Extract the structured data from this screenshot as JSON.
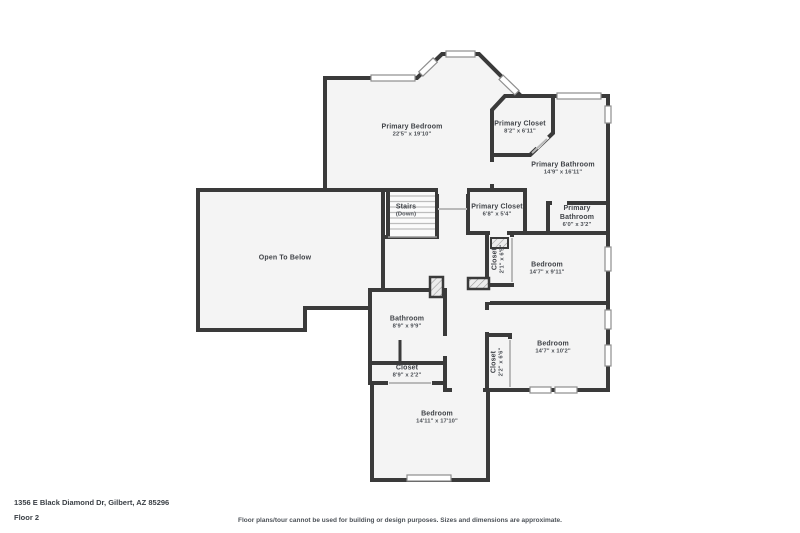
{
  "colors": {
    "wall": "#3a3a3a",
    "floor": "#f4f4f4",
    "window_border": "#8e8e8e",
    "door_line": "#b9b9b9",
    "label_text": "#3f4247"
  },
  "floor_plan": {
    "rooms": [
      {
        "id": "primary-bedroom",
        "name": "Primary Bedroom",
        "dims": "22'5\" x 19'10\""
      },
      {
        "id": "primary-closet-upper",
        "name": "Primary Closet",
        "dims": "8'2\" x 6'11\""
      },
      {
        "id": "primary-bathroom",
        "name": "Primary Bathroom",
        "dims": "14'9\" x 16'11\""
      },
      {
        "id": "stairs",
        "name": "Stairs",
        "dims": "(Down)"
      },
      {
        "id": "primary-closet-hall",
        "name": "Primary Closet",
        "dims": "6'8\" x 5'4\""
      },
      {
        "id": "primary-bathroom-wc",
        "name": "Primary Bathroom",
        "dims": "6'0\" x 3'2\""
      },
      {
        "id": "open-to-below",
        "name": "Open To Below",
        "dims": ""
      },
      {
        "id": "closet-bedroom1",
        "name": "Closet",
        "dims": "2'1\" x 6'5\""
      },
      {
        "id": "bedroom1",
        "name": "Bedroom",
        "dims": "14'7\" x 9'11\""
      },
      {
        "id": "bathroom",
        "name": "Bathroom",
        "dims": "8'9\" x 9'9\""
      },
      {
        "id": "bedroom2",
        "name": "Bedroom",
        "dims": "14'7\" x 10'2\""
      },
      {
        "id": "closet-bedroom2",
        "name": "Closet",
        "dims": "2'2\" x 6'6\""
      },
      {
        "id": "closet-hall",
        "name": "Closet",
        "dims": "8'9\" x 2'2\""
      },
      {
        "id": "bedroom3",
        "name": "Bedroom",
        "dims": "14'11\" x 17'10\""
      }
    ]
  },
  "footer": {
    "address": "1356 E Black Diamond Dr, Gilbert, AZ 85296",
    "floor_label": "Floor 2",
    "disclaimer": "Floor plans/tour cannot be used for building or design purposes. Sizes and dimensions are approximate."
  }
}
